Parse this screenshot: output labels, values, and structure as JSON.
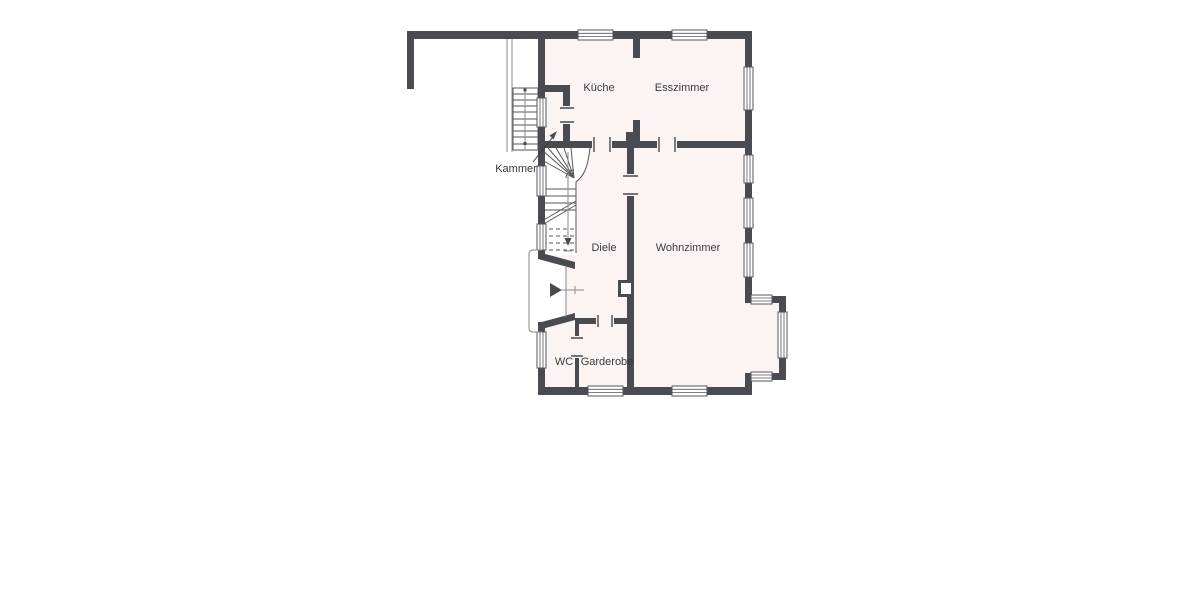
{
  "plan": {
    "rooms": {
      "kueche": "Küche",
      "esszimmer": "Esszimmer",
      "kammer": "Kammer",
      "diele": "Diele",
      "wohnzimmer": "Wohnzimmer",
      "wc": "WC",
      "garderobe": "Garderobe"
    },
    "colors": {
      "wall": "#4a4a51",
      "room_fill": "#fcf4f3",
      "window": "#ffffff",
      "outline": "#55555c",
      "label_text": "#3a3a3a",
      "background": "#ffffff"
    }
  }
}
